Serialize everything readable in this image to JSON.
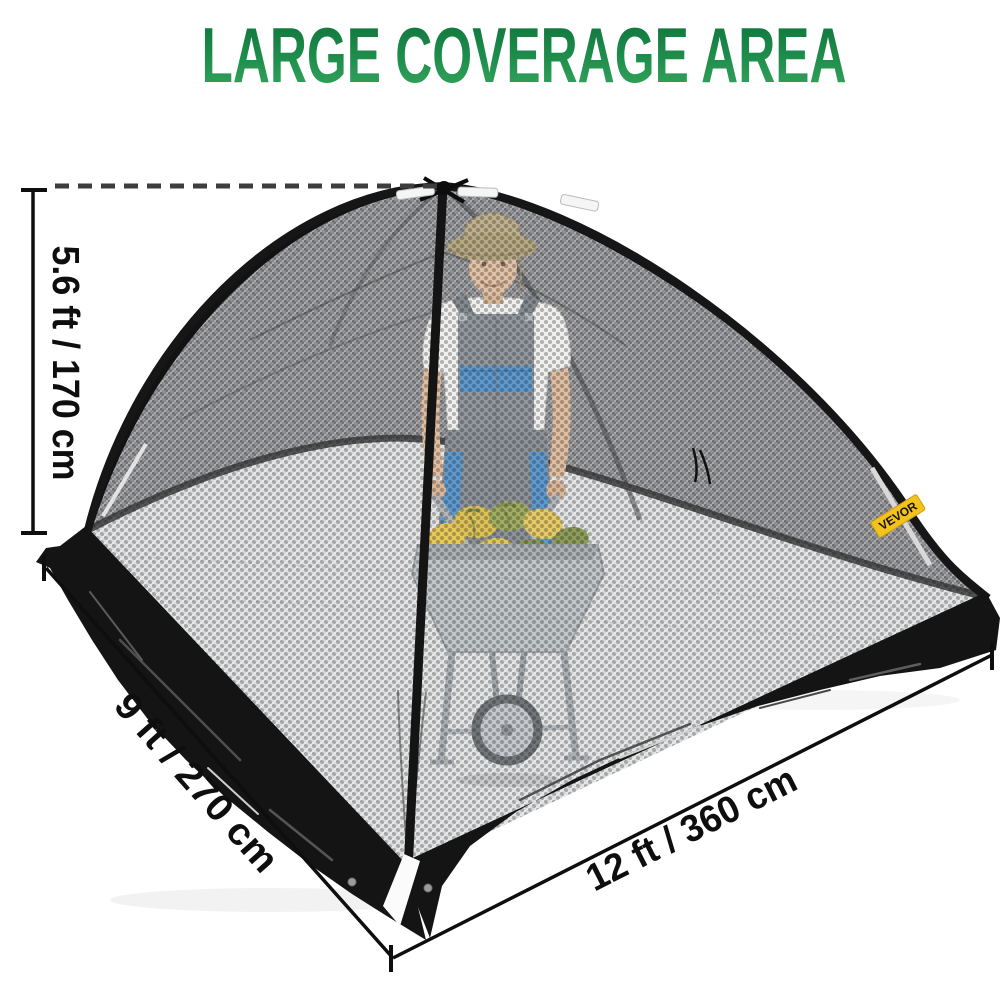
{
  "title": {
    "text": "LARGE COVERAGE AREA",
    "gradient_top": "#0d6e39",
    "gradient_mid": "#1d8c4b",
    "gradient_bottom": "#38a95e"
  },
  "dimensions": {
    "height": {
      "label": "5.6 ft / 170 cm"
    },
    "depth": {
      "label": "9 ft / 270 cm"
    },
    "width": {
      "label": "12 ft / 360 cm"
    }
  },
  "brand_tag": {
    "text": "VEVOR",
    "bg_color": "#f3c21d",
    "text_color": "#161616"
  },
  "scene": {
    "product": "black mesh dome cover net tent with black tarp skirt",
    "subject": "man in bucket hat and overalls pushing a wheelbarrow of squash inside the net",
    "colors": {
      "mesh_light": "#e2e3e4",
      "mesh_dark": "#9a9b9d",
      "tarp": "#141414",
      "pole": "#151515",
      "dimension_lines": "#101010",
      "background": "#ffffff"
    }
  }
}
